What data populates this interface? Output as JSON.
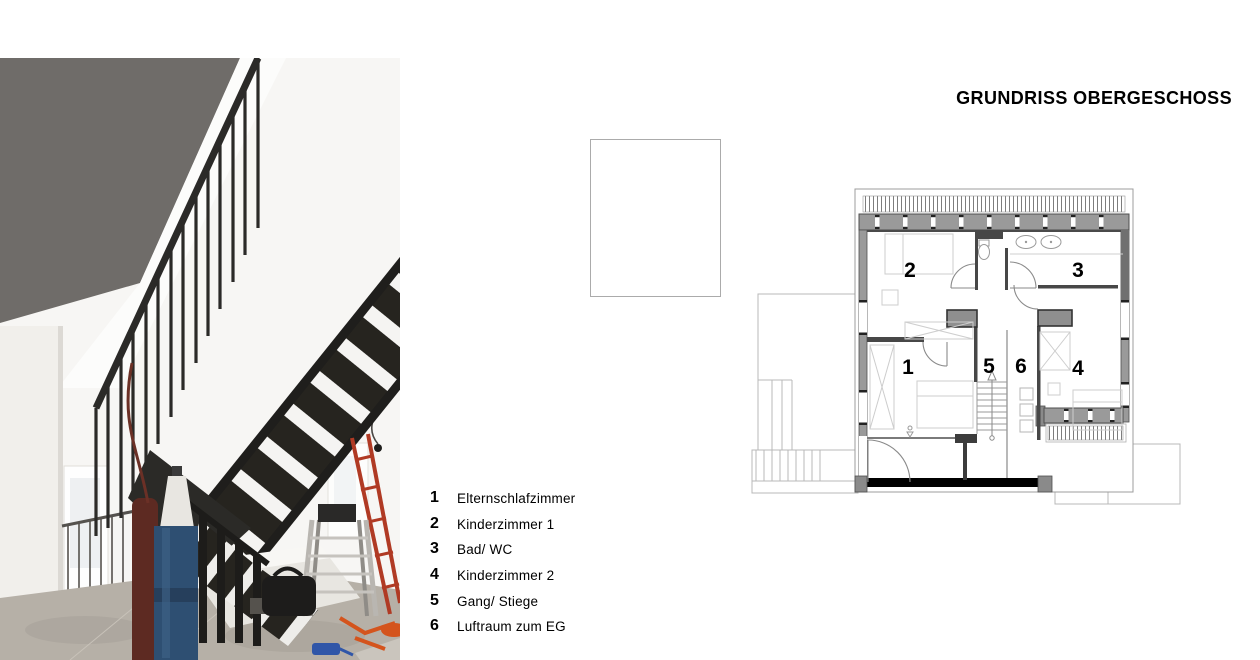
{
  "title": {
    "text": "GRUNDRISS OBERGESCHOSS"
  },
  "legend": {
    "items": [
      {
        "num": "1",
        "label": "Elternschlafzimmer"
      },
      {
        "num": "2",
        "label": "Kinderzimmer 1"
      },
      {
        "num": "3",
        "label": "Bad/ WC"
      },
      {
        "num": "4",
        "label": "Kinderzimmer 2"
      },
      {
        "num": "5",
        "label": "Gang/ Stiege"
      },
      {
        "num": "6",
        "label": "Luftraum zum EG"
      }
    ]
  },
  "plan": {
    "room_numbers": {
      "r1": "1",
      "r2": "2",
      "r3": "3",
      "r4": "4",
      "r5": "5",
      "r6": "6"
    }
  },
  "photo": {
    "description": "construction-site interior with black steel open-riser staircase, railings, blue gas cylinder, ladders"
  },
  "colors": {
    "wall_gray": "#9a9a9a",
    "dark_wall": "#474747",
    "black_wall": "#000000",
    "ceiling_gray": "#6f6c69",
    "stair_steel": "#26241f",
    "cylinder_blue": "#2e4f72",
    "cylinder_maroon": "#5d2a22",
    "ladder_red": "#b03a24",
    "debris_orange": "#d4541d",
    "floor_concrete": "#b6b0a7"
  }
}
